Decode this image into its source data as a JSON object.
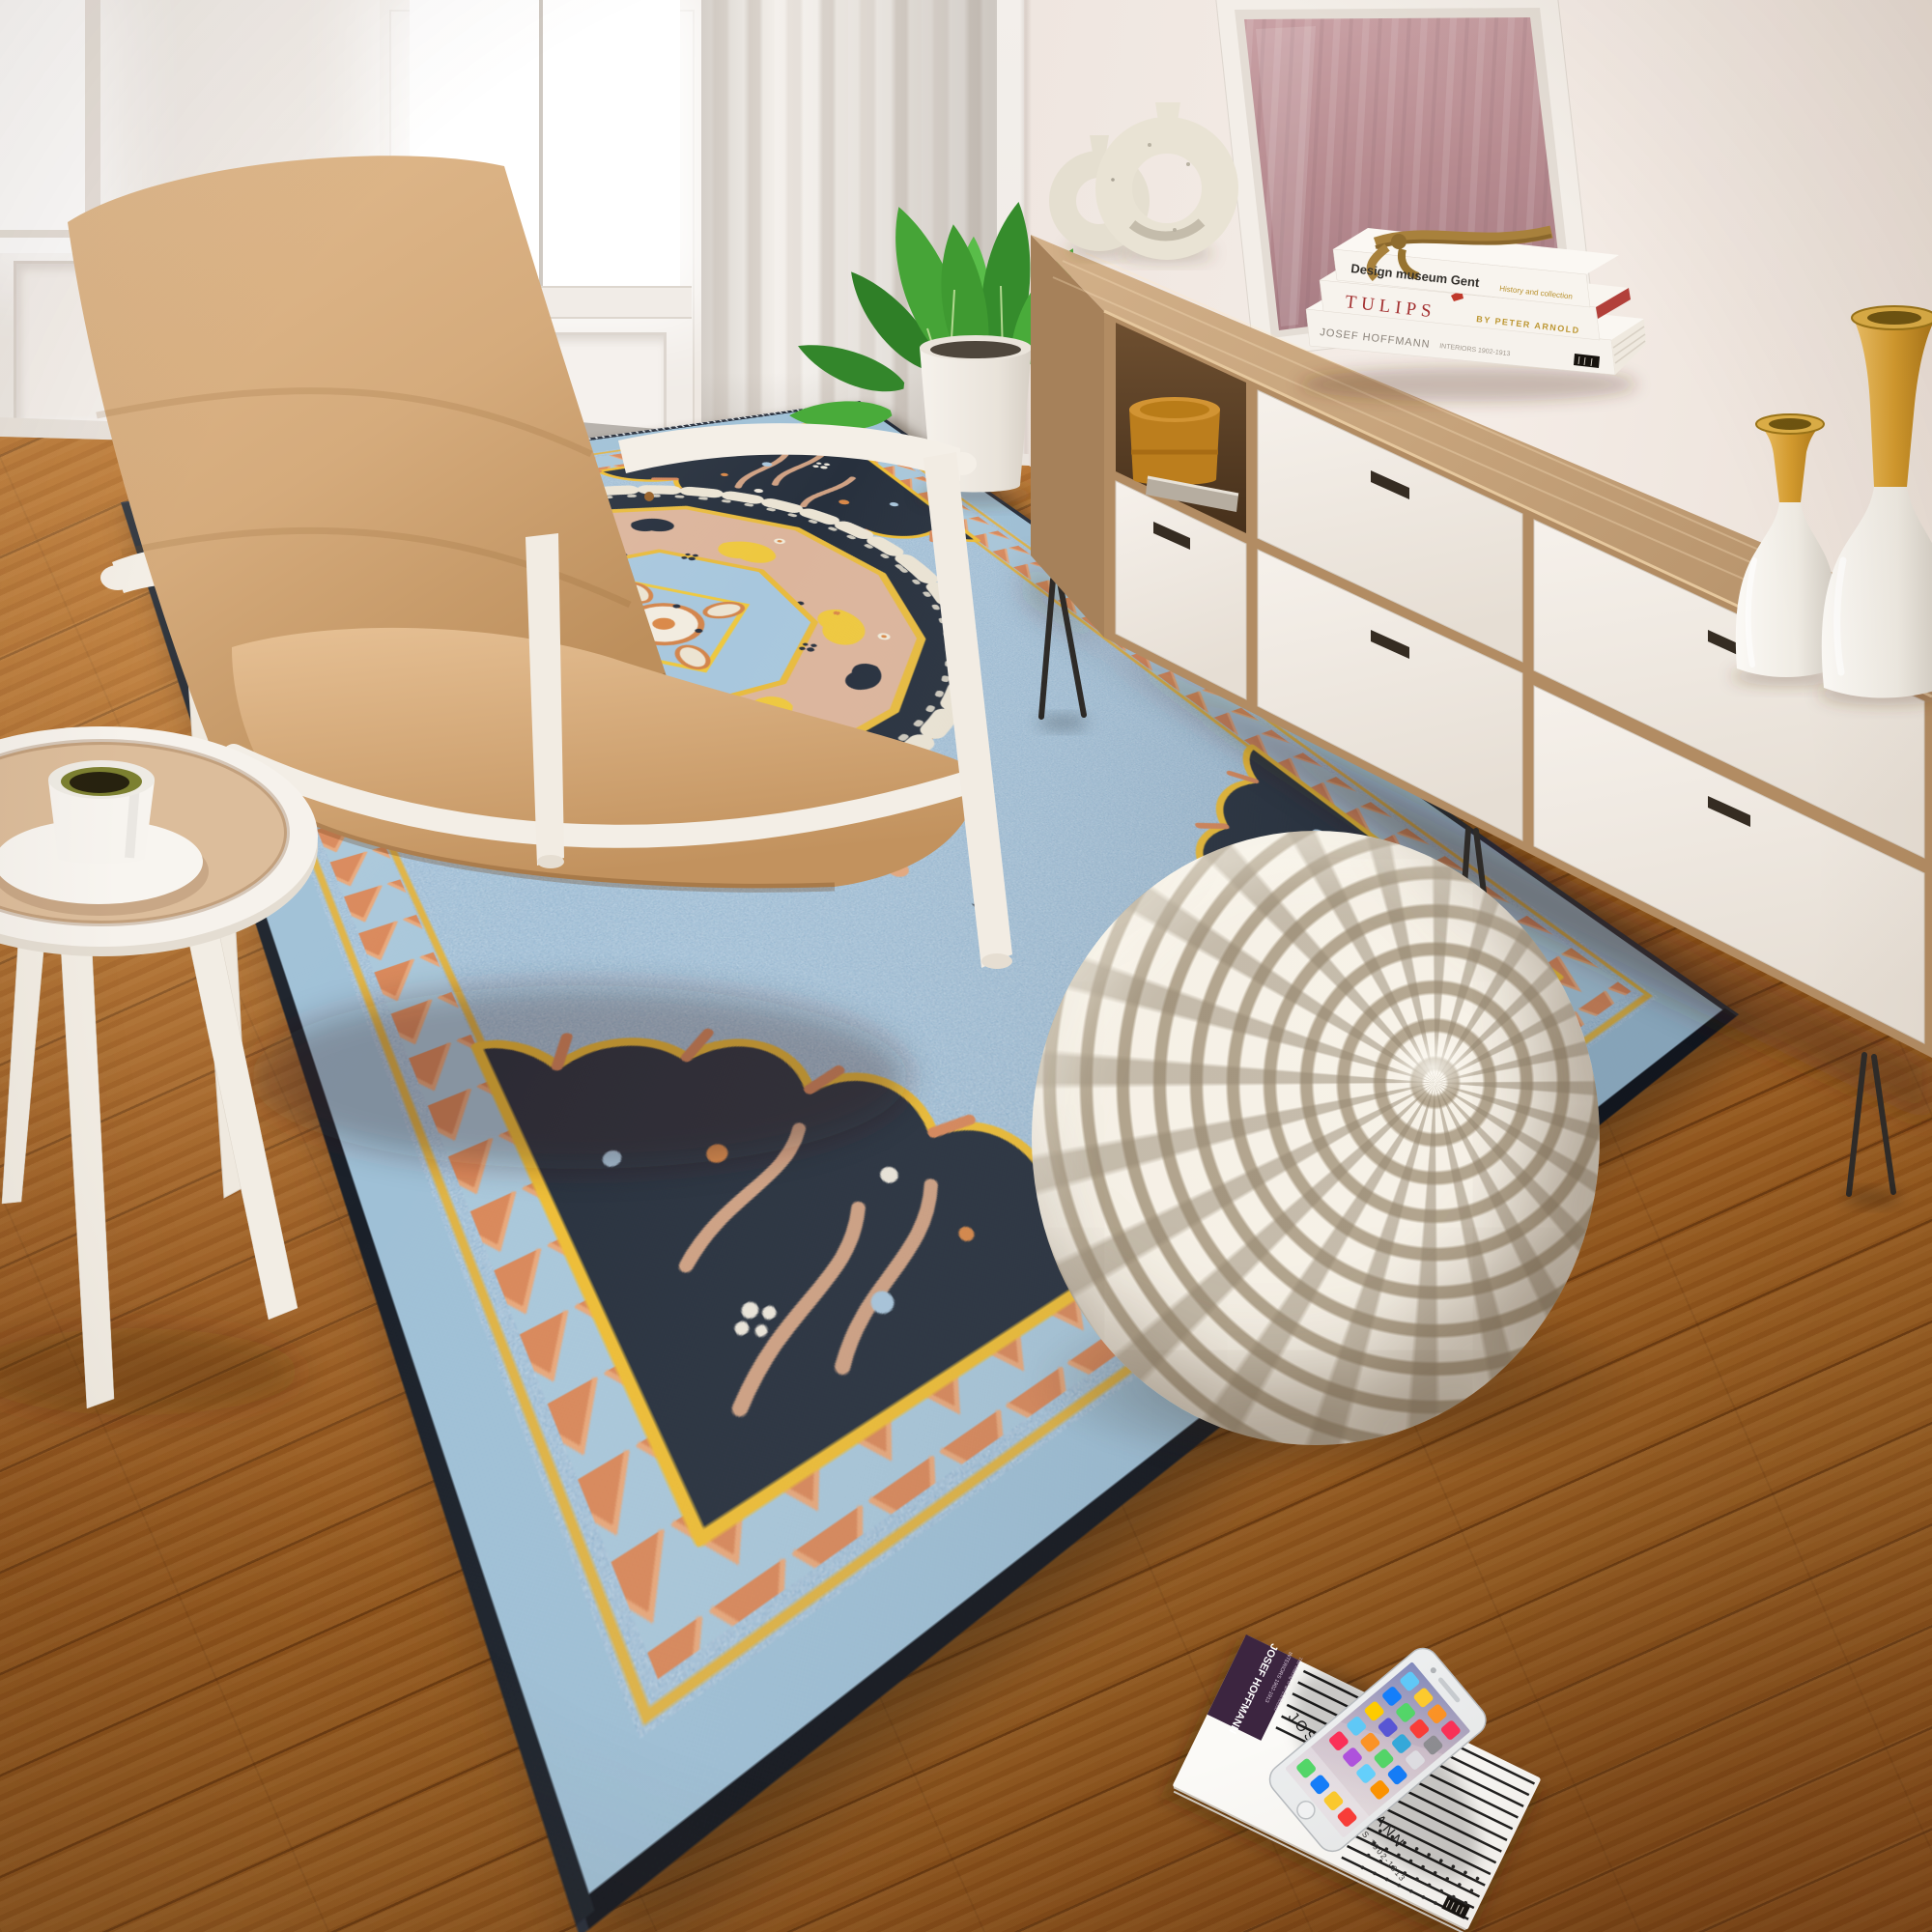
{
  "scene": {
    "type": "interior product photograph",
    "room": "living room with area rug"
  },
  "palette": {
    "wall": "#f2ebe6",
    "floor_wood": "#a2601f",
    "rug_field": "#8fb7d3",
    "rug_navy": "#27303d",
    "rug_peach": "#dcb59c",
    "rug_yellow": "#eec23f",
    "rug_orange": "#d9885a",
    "rug_cream": "#ebe4d4",
    "pouf_cream": "#efe8da",
    "pouf_taupe": "#ada08a",
    "chair_leather": "#d5ad7f",
    "chair_frame": "#f4efe7",
    "sideboard_wood": "#c2a079",
    "drawer_front": "#f3eee8",
    "mirror_glass": "#bb939a",
    "vase_gold": "#d9a43c",
    "canister": "#bc7e1d",
    "plant_green": "#3f9a31"
  },
  "sideboard": {
    "books": [
      {
        "title": "Design museum Gent",
        "subtitle": "History and collection"
      },
      {
        "title": "TULIPS",
        "author": "BY PETER ARNOLD"
      },
      {
        "title": "JOSEF HOFFMANN",
        "subtitle": "INTERIORS 1902-1913"
      }
    ]
  },
  "floor_book": {
    "spine_title": "JOSEF HOFFMANN",
    "spine_line2": "INTERIORS 1902-1913",
    "spine_line3": "The Making of an Exhibition",
    "cover_title": "JOSEF HOFFMANN",
    "cover_subtitle": "INTERIORS 1902-1913"
  },
  "phone": {
    "icon_colors": [
      "#5fc9f8",
      "#fecb2e",
      "#fd9426",
      "#fc3158",
      "#147efb",
      "#53d769",
      "#fc3d39",
      "#8e8e93",
      "#ffcc00",
      "#5856d6",
      "#34aadc",
      "#e0e0e5",
      "#5fc9f8",
      "#fd9426",
      "#53d769",
      "#147efb",
      "#fc3158",
      "#af52de",
      "#64d2ff",
      "#ff9500"
    ],
    "dock_colors": [
      "#53d769",
      "#147efb",
      "#fecb2e",
      "#fc3d39"
    ]
  }
}
